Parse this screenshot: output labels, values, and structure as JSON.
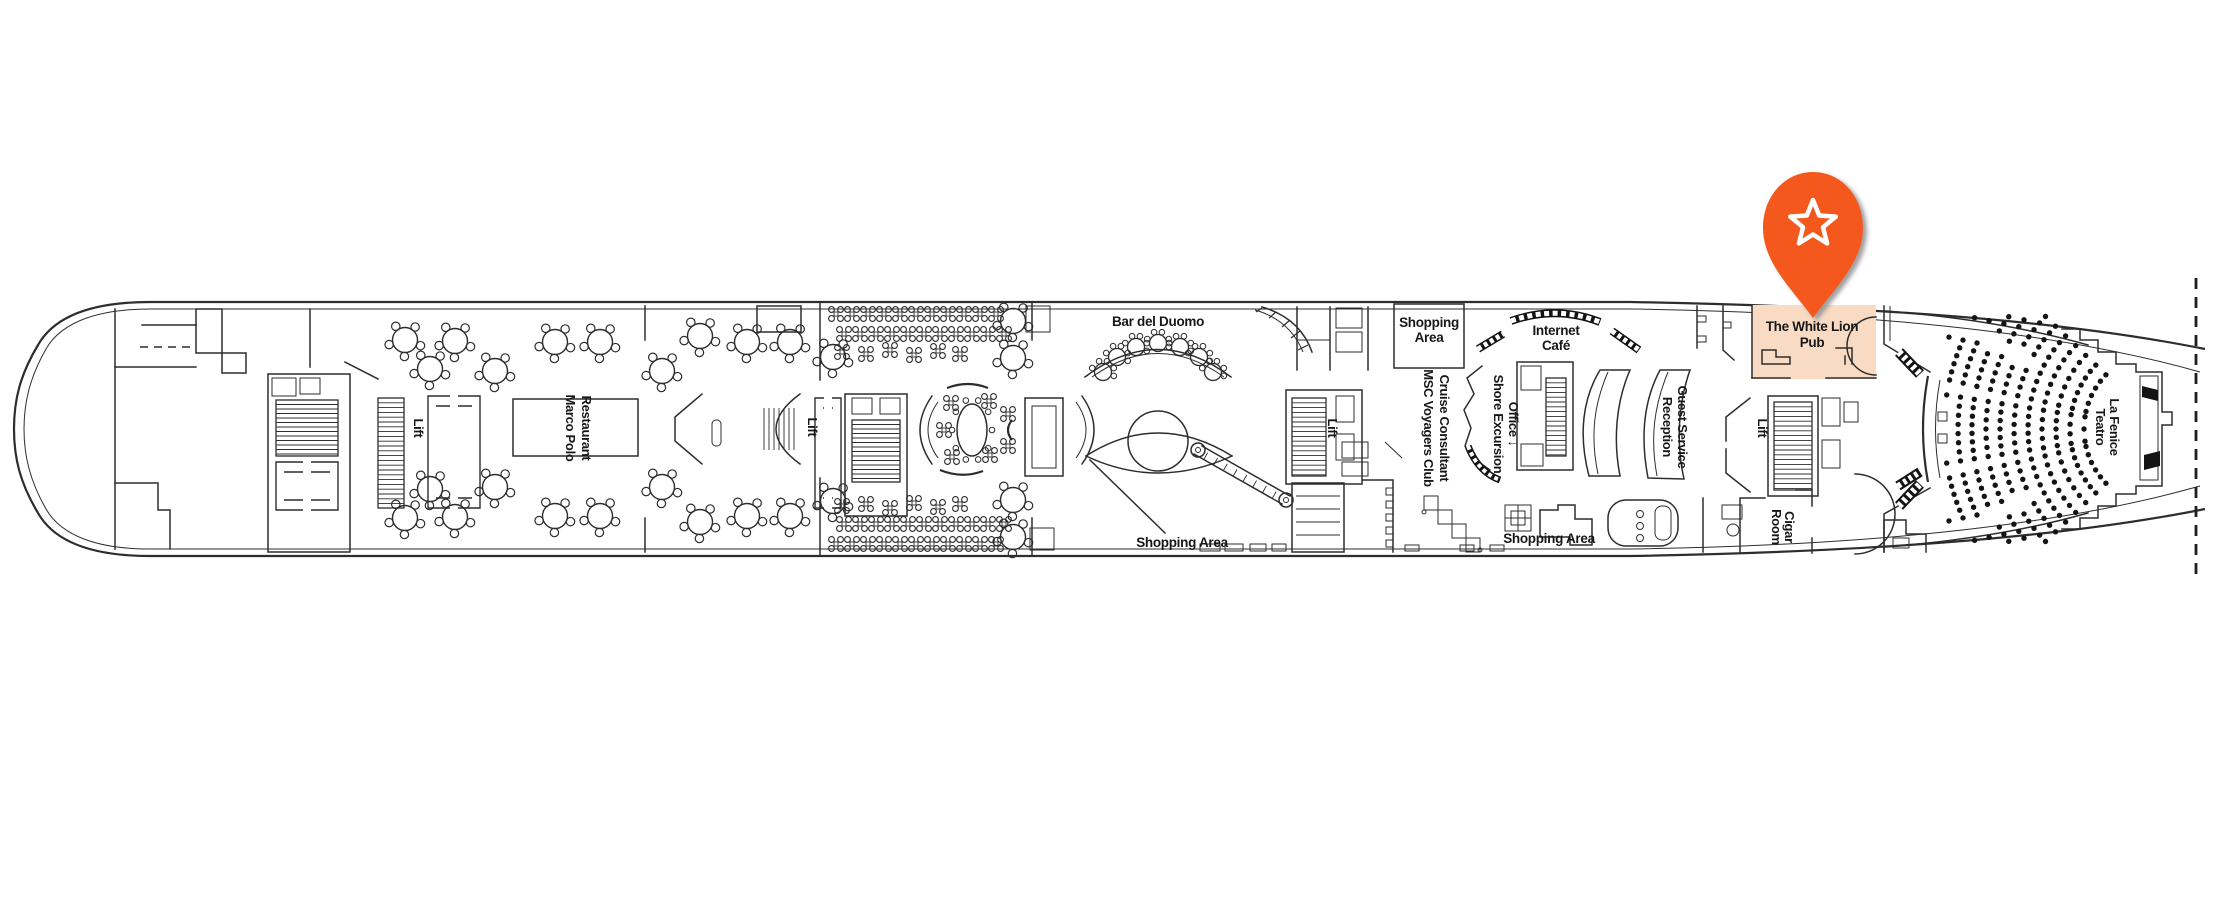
{
  "deck_plan": {
    "type": "cruise-ship-deck-floor-plan",
    "colors": {
      "background": "#ffffff",
      "line": "#2d2d2d",
      "seat": "#141414",
      "highlight": "#f8dbc2",
      "pin": "#f4581c",
      "pin_shadow": "#8f8f8f",
      "star": "#ffffff"
    },
    "marker": {
      "icon": "star-icon",
      "style": "map-pin",
      "points_to": "The White Lion Pub"
    },
    "highlight": {
      "venue_line1": "The White Lion",
      "venue_line2": "Pub"
    },
    "labels": {
      "marco_polo": {
        "l1": "Marco Polo",
        "l2": "Restaurant"
      },
      "lift": "Lift",
      "bar_del_duomo": "Bar del Duomo",
      "shopping_box": {
        "l1": "Shopping",
        "l2": "Area"
      },
      "internet_cafe": {
        "l1": "Internet",
        "l2": "Café"
      },
      "cruise_consultant": {
        "l1": "Cruise Consultant",
        "l2": "MSC Voyagers Club"
      },
      "shore_excursion": {
        "l1": "Shore Excursion",
        "l2": "Office ↓"
      },
      "reception": {
        "l1": "Reception",
        "l2": "Guest Service"
      },
      "shopping_mid": "Shopping Area",
      "shopping_fwd": "Shopping Area",
      "cigar_room": {
        "l1": "Cigar",
        "l2": "Room"
      },
      "white_lion": {
        "l1": "The White Lion",
        "l2": "Pub"
      },
      "teatro": {
        "l1": "Teatro",
        "l2": "La Fenice"
      }
    }
  }
}
